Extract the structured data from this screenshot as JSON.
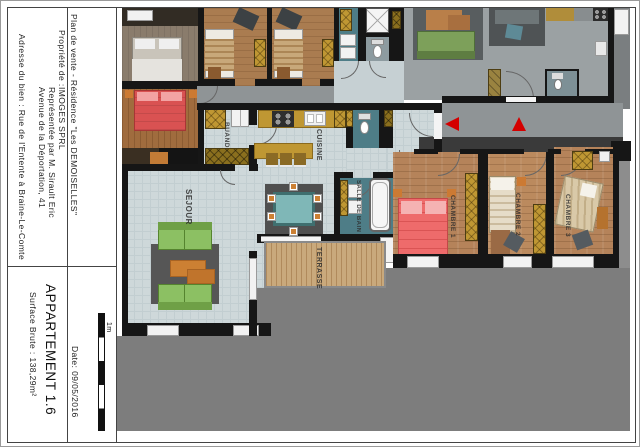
{
  "title_block": {
    "project": "Plan de vente - Résidence \"Les DEMOISELLES\"",
    "owner_label": "Propriété de :",
    "owner_company": "IMOGES SPRL",
    "owner_representative": "Représentée par M. Sirault Eric",
    "owner_address": "Avenue de la Déportation, 41",
    "property_address": "Adresse du bien : Rue de l'Entente à Braine-Le-Comte",
    "apartment_title": "APPARTEMENT 1.6",
    "surface": "Surface Brute : 138,29m²",
    "date": "Date: 09/05/2016"
  },
  "scale": {
    "label": "1m"
  },
  "rooms": {
    "sejour": "SEJOUR",
    "buanderie": "BUAND.",
    "cuisine": "CUISINE",
    "salle_de_bain": "SALLE DE BAIN",
    "chambre1": "CHAMBRE 1",
    "chambre2": "CHAMBRE 2",
    "chambre3": "CHAMBRE 3",
    "terrasse": "TERRASSE"
  },
  "palette": {
    "wall": "#161616",
    "light_floor": "#ced8da",
    "wood_floor": "#b5835a",
    "teal_floor": "#4e7d87",
    "cabinet_yellow": "#bf9733",
    "bed_red": "#ee6b6b",
    "sofa_green": "#8cc063",
    "table_orange": "#cc8033",
    "exterior_gray": "#7d7d7d",
    "corridor_gray": "#8f9496",
    "entrance_arrow_red": "#d40000"
  }
}
